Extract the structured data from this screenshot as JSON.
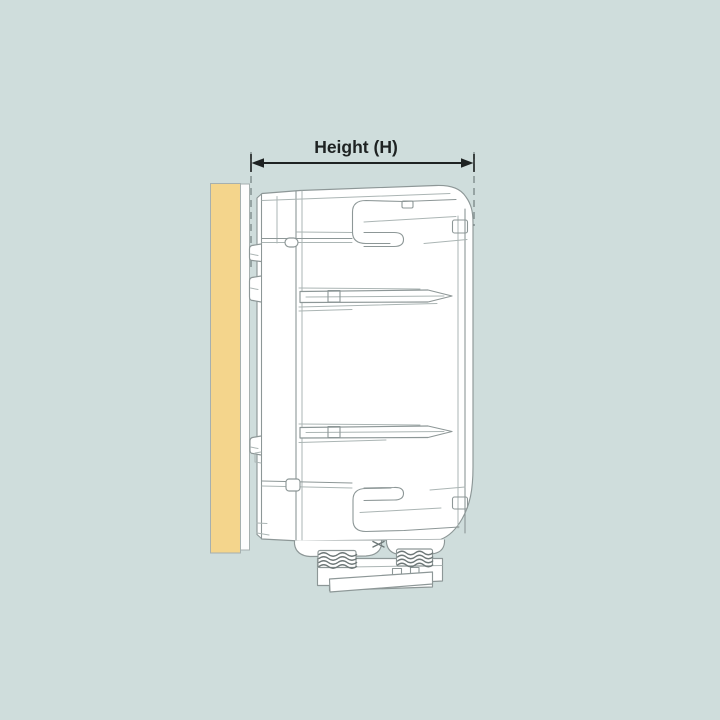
{
  "diagram": {
    "dimension_label": "Height (H)",
    "colors": {
      "background": "#cfdddc",
      "wall_fill": "#f4d58c",
      "wall_edge": "#a6b0af",
      "strip_fill": "#fdfdfd",
      "device_fill": "#ffffff",
      "line": "#8d9797",
      "line_light": "#abb5b4",
      "line_dark": "#6e7878",
      "arrow": "#1e2222",
      "dash": "#7e8b8b"
    }
  }
}
